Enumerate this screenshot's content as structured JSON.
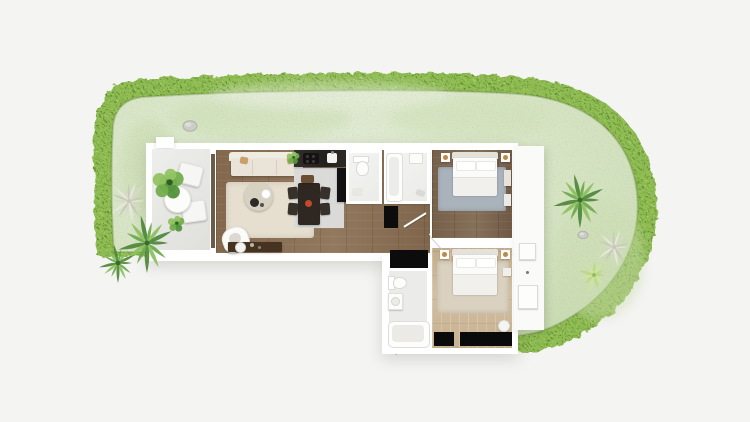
{
  "scene": {
    "background": "#f4f4f3",
    "width": 750,
    "height": 422,
    "description": "Top-down 3D render of an L-shaped apartment floor plan with terrace, garden lawn and hedge border"
  },
  "palette": {
    "hedge": "#8fbc52",
    "hedge_dark": "#4e7d26",
    "hedge_light": "#bdda78",
    "lawn": "#d9e6c8",
    "lawn_dark": "#c2d7ab",
    "lawn_light": "#e6eedb",
    "lawn_speckle": "#a3bd85",
    "wall": "#ffffff",
    "terrace_floor": "#e9e9e6",
    "walkway_floor": "#fafaf8",
    "wood_living": "#8a6f54",
    "wood_bed1": "#7c644c",
    "wood_bed2": "#c9b394",
    "bath_floor": "#f0f0ee",
    "bath2_floor": "#f2f2f0",
    "bath3_floor": "#ebebe9",
    "rug_living": "#e6dfd0",
    "rug_bed1": "#aab3bc",
    "rug_bed2": "#dad1c0",
    "sofa": "#e9e4d7",
    "sofa_back": "#efece1",
    "armchair": "#e7e4de",
    "coffee_table": "#d7d1c2",
    "console": "#46331f",
    "dining_table": "#2f2822",
    "chair_dark": "#38302a",
    "chair_wood": "#6b4f35",
    "counter": "#2a2522",
    "cooktop": "#151312",
    "kitchen_mat": "#dadbd9",
    "fridge": "#121212",
    "wardrobe": "#0c0c0c",
    "window_glass": "#0a0a0a",
    "glass_frame": "#6b5b49",
    "bed_linen": "#fbfbf9",
    "headboard": "#e4e1db",
    "blanket": "#f1f0ed",
    "lamp": "#b98a4a",
    "accent_red": "#c04a2a",
    "rock": "#cbcbc7",
    "palm_greens": [
      "#4d8738",
      "#6aa84b",
      "#8cc05e"
    ],
    "agave_tones": [
      "#e9e7df",
      "#d9d7cb",
      "#c7c7ba"
    ],
    "bush_greens": [
      "#55933d",
      "#74ad4e",
      "#92c463"
    ],
    "shrub_light": [
      "#bcd985",
      "#cfe49d"
    ]
  },
  "rooms": [
    {
      "id": "garden",
      "name": "Garden"
    },
    {
      "id": "terrace",
      "name": "Terrace"
    },
    {
      "id": "living-kitchen",
      "name": "Living room with open kitchen"
    },
    {
      "id": "wc",
      "name": "WC"
    },
    {
      "id": "bathroom",
      "name": "Bathroom"
    },
    {
      "id": "hallway",
      "name": "Hallway"
    },
    {
      "id": "bedroom-1",
      "name": "Bedroom 1"
    },
    {
      "id": "bedroom-2",
      "name": "Bedroom 2"
    },
    {
      "id": "bathroom-2",
      "name": "Second bathroom"
    },
    {
      "id": "walkway",
      "name": "Side walkway"
    }
  ],
  "plants": [
    {
      "type": "bush",
      "x": 168,
      "y": 184,
      "r": 17
    },
    {
      "type": "agave",
      "x": 129,
      "y": 201,
      "r": 22
    },
    {
      "type": "palm",
      "x": 147,
      "y": 243,
      "r": 30
    },
    {
      "type": "palm",
      "x": 118,
      "y": 263,
      "r": 20
    },
    {
      "type": "rock",
      "x": 190,
      "y": 126,
      "r": 7
    },
    {
      "type": "palm",
      "x": 580,
      "y": 200,
      "r": 28
    },
    {
      "type": "rock",
      "x": 583,
      "y": 235,
      "r": 5
    },
    {
      "type": "agave",
      "x": 614,
      "y": 247,
      "r": 20
    },
    {
      "type": "shrub",
      "x": 594,
      "y": 275,
      "r": 16
    },
    {
      "type": "bush",
      "x": 176,
      "y": 224,
      "r": 9
    },
    {
      "type": "bush",
      "x": 293,
      "y": 158,
      "r": 7
    }
  ]
}
